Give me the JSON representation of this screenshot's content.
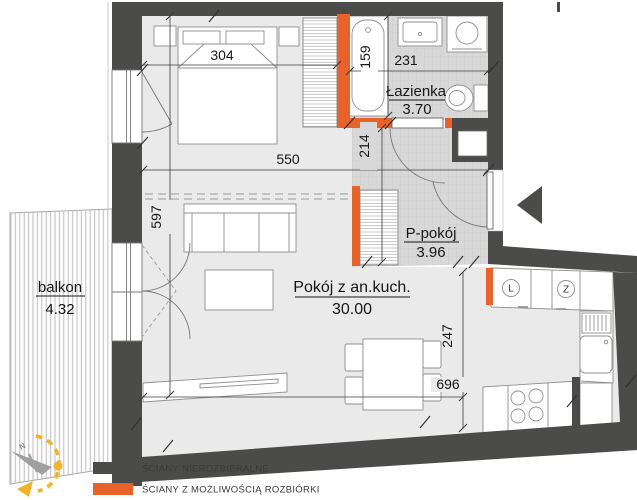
{
  "plan": {
    "rooms": [
      {
        "name": "Łazienka",
        "area": "3.70"
      },
      {
        "name": "P-pokój",
        "area": "3.96"
      },
      {
        "name": "Pokój z an.kuch.",
        "area": "30.00"
      },
      {
        "name": "balkon",
        "area": "4.32"
      }
    ],
    "dimensions": {
      "bedroom_width": "304",
      "bathroom_width": "231",
      "bathtub_wall": "159",
      "hall_depth": "214",
      "living_upper_width": "550",
      "apartment_depth": "597",
      "kitchen_depth": "247",
      "living_width": "696"
    },
    "appliances": {
      "fridge": "L",
      "dishwasher": "Z"
    },
    "compass": {
      "north": "N"
    }
  },
  "legend": {
    "items": [
      {
        "label": "ŚCIANY NIEROZBIERALNE",
        "color": "#4b4b49"
      },
      {
        "label": "ŚCIANY Z MOŻLIWOŚCIĄ ROZBIÓRKI",
        "color": "#e8632c"
      }
    ]
  },
  "colors": {
    "wall": "#4b4b49",
    "demolition_wall": "#e8632c",
    "floor": "#eaeaea",
    "tile": "#d8d8d8",
    "compass_accent": "#f0b32a"
  }
}
